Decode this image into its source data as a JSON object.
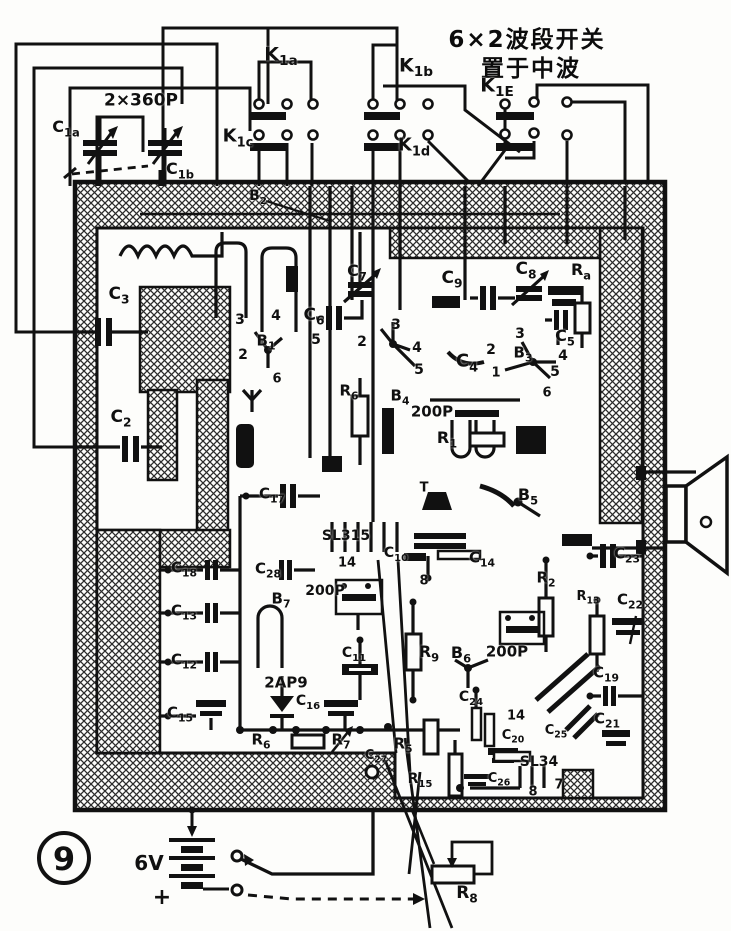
{
  "title": {
    "line1": "6×2波段开关",
    "line2": "置于中波"
  },
  "figure_number": "9",
  "colors": {
    "ink": "#111111",
    "paper": "#fdfdfb"
  },
  "battery": {
    "voltage": "6V",
    "polarity": "+"
  },
  "labels": [
    {
      "n": "switch-k1a-label",
      "t": "K1a",
      "sub": 1,
      "x": 281,
      "y": 57,
      "s": 19
    },
    {
      "n": "switch-k1b-label",
      "t": "K1b",
      "sub": 1,
      "x": 416,
      "y": 68,
      "s": 19
    },
    {
      "n": "switch-k1c-label",
      "t": "K1c",
      "sub": 1,
      "x": 238,
      "y": 139,
      "s": 18
    },
    {
      "n": "switch-k1d-label",
      "t": "K1d",
      "sub": 1,
      "x": 414,
      "y": 148,
      "s": 18
    },
    {
      "n": "switch-k1e-label",
      "t": "K1E",
      "sub": 1,
      "x": 497,
      "y": 88,
      "s": 19
    },
    {
      "n": "tuning-cap-value",
      "t": "2×360P",
      "x": 141,
      "y": 101,
      "s": 17
    },
    {
      "n": "cap-c1a-label",
      "t": "C1a",
      "sub": 1,
      "x": 66,
      "y": 129,
      "s": 16
    },
    {
      "n": "cap-c1b-label",
      "t": "C1b",
      "sub": 1,
      "x": 180,
      "y": 171,
      "s": 16
    },
    {
      "n": "shield-b2-label",
      "t": "B2",
      "sub": 1,
      "x": 258,
      "y": 198,
      "s": 14
    },
    {
      "n": "cap-c3-label",
      "t": "C3",
      "sub": 1,
      "x": 119,
      "y": 296,
      "s": 17
    },
    {
      "n": "cap-c2-label",
      "t": "C2",
      "sub": 1,
      "x": 121,
      "y": 419,
      "s": 17
    },
    {
      "n": "pin3-b1",
      "t": "3",
      "x": 240,
      "y": 320,
      "s": 14
    },
    {
      "n": "pin4-b1",
      "t": "4",
      "x": 276,
      "y": 316,
      "s": 14
    },
    {
      "n": "pin2-b1",
      "t": "2",
      "x": 243,
      "y": 355,
      "s": 14
    },
    {
      "n": "transistor-b1-label",
      "t": "B1",
      "sub": 1,
      "x": 266,
      "y": 343,
      "s": 15
    },
    {
      "n": "pin5-b1",
      "t": "5",
      "x": 316,
      "y": 340,
      "s": 14
    },
    {
      "n": "pin6-b1",
      "t": "6",
      "x": 277,
      "y": 379,
      "s": 13
    },
    {
      "n": "cap-c6-label",
      "t": "C6",
      "sub": 1,
      "x": 314,
      "y": 317,
      "s": 17
    },
    {
      "n": "cap-c7-label",
      "t": "C7",
      "sub": 1,
      "x": 357,
      "y": 273,
      "s": 16
    },
    {
      "n": "cap-c9-label",
      "t": "C9",
      "sub": 1,
      "x": 452,
      "y": 280,
      "s": 17
    },
    {
      "n": "cap-c8-label",
      "t": "C8",
      "sub": 1,
      "x": 526,
      "y": 271,
      "s": 17
    },
    {
      "n": "res-ra-label",
      "t": "Ra",
      "sub": 1,
      "x": 581,
      "y": 272,
      "s": 16
    },
    {
      "n": "pin3-b2",
      "t": "3",
      "x": 396,
      "y": 325,
      "s": 14
    },
    {
      "n": "pin2-b2",
      "t": "2",
      "x": 362,
      "y": 342,
      "s": 14
    },
    {
      "n": "pin4-b2",
      "t": "4",
      "x": 417,
      "y": 348,
      "s": 14
    },
    {
      "n": "pin5-b2",
      "t": "5",
      "x": 419,
      "y": 370,
      "s": 14
    },
    {
      "n": "cap-c4-label",
      "t": "C4",
      "sub": 1,
      "x": 467,
      "y": 364,
      "s": 18
    },
    {
      "n": "transistor-b3-label",
      "t": "B3",
      "sub": 1,
      "x": 523,
      "y": 355,
      "s": 15
    },
    {
      "n": "pin3-b3",
      "t": "3",
      "x": 520,
      "y": 334,
      "s": 14
    },
    {
      "n": "pin2-b3",
      "t": "2",
      "x": 491,
      "y": 350,
      "s": 14
    },
    {
      "n": "pin4-b3",
      "t": "4",
      "x": 563,
      "y": 356,
      "s": 14
    },
    {
      "n": "pin5-b3",
      "t": "5",
      "x": 555,
      "y": 372,
      "s": 14
    },
    {
      "n": "pin1-b3",
      "t": "1",
      "x": 496,
      "y": 373,
      "s": 13
    },
    {
      "n": "pin6-b3",
      "t": "6",
      "x": 547,
      "y": 393,
      "s": 13
    },
    {
      "n": "cap-c5-label",
      "t": "C5",
      "sub": 1,
      "x": 565,
      "y": 338,
      "s": 16
    },
    {
      "n": "res-r6-upper-label",
      "t": "R6",
      "sub": 1,
      "x": 349,
      "y": 393,
      "s": 15
    },
    {
      "n": "transistor-b4-label",
      "t": "B4",
      "sub": 1,
      "x": 400,
      "y": 398,
      "s": 15
    },
    {
      "n": "trimmer-200p-1",
      "t": "200P",
      "x": 432,
      "y": 412,
      "s": 15
    },
    {
      "n": "res-r1-label",
      "t": "R1",
      "sub": 1,
      "x": 447,
      "y": 440,
      "s": 16
    },
    {
      "n": "t-mark",
      "t": "T",
      "x": 424,
      "y": 488,
      "s": 13
    },
    {
      "n": "transistor-b5-label",
      "t": "B5",
      "sub": 1,
      "x": 528,
      "y": 497,
      "s": 16
    },
    {
      "n": "cap-c17-label",
      "t": "C17",
      "sub": 1,
      "x": 272,
      "y": 496,
      "s": 15
    },
    {
      "n": "cap-c28-label",
      "t": "C28",
      "sub": 1,
      "x": 268,
      "y": 571,
      "s": 15
    },
    {
      "n": "ic-sl315-label",
      "t": "SL315",
      "x": 346,
      "y": 536,
      "s": 14
    },
    {
      "n": "pin14-sl315",
      "t": "14",
      "x": 347,
      "y": 563,
      "s": 13
    },
    {
      "n": "cap-c10-label",
      "t": "C10",
      "sub": 1,
      "x": 396,
      "y": 555,
      "s": 14
    },
    {
      "n": "pin8-sl315",
      "t": "8",
      "x": 424,
      "y": 581,
      "s": 13
    },
    {
      "n": "cap-c14-label",
      "t": "C14",
      "sub": 1,
      "x": 482,
      "y": 560,
      "s": 15
    },
    {
      "n": "cap-c18-label",
      "t": "C18",
      "sub": 1,
      "x": 184,
      "y": 570,
      "s": 15
    },
    {
      "n": "cap-c13-label",
      "t": "C13",
      "sub": 1,
      "x": 184,
      "y": 613,
      "s": 15
    },
    {
      "n": "transistor-b7-label",
      "t": "B7",
      "sub": 1,
      "x": 281,
      "y": 601,
      "s": 15
    },
    {
      "n": "trimmer-200p-2",
      "t": "200P",
      "x": 325,
      "y": 591,
      "s": 14
    },
    {
      "n": "cap-c12-label",
      "t": "C12",
      "sub": 1,
      "x": 184,
      "y": 662,
      "s": 15
    },
    {
      "n": "diode-2ap9-label",
      "t": "2AP9",
      "x": 286,
      "y": 683,
      "s": 15
    },
    {
      "n": "cap-c11-label",
      "t": "C11",
      "sub": 1,
      "x": 354,
      "y": 655,
      "s": 14
    },
    {
      "n": "cap-c15-label",
      "t": "C15",
      "sub": 1,
      "x": 180,
      "y": 715,
      "s": 15
    },
    {
      "n": "cap-c16-label",
      "t": "C16",
      "sub": 1,
      "x": 308,
      "y": 703,
      "s": 14
    },
    {
      "n": "res-r6-lower-label",
      "t": "R6",
      "sub": 1,
      "x": 261,
      "y": 742,
      "s": 15
    },
    {
      "n": "res-r7-label",
      "t": "R7",
      "sub": 1,
      "x": 341,
      "y": 742,
      "s": 15
    },
    {
      "n": "cap-c27-label",
      "t": "C27",
      "sub": 1,
      "x": 376,
      "y": 757,
      "s": 13
    },
    {
      "n": "res-r5-label",
      "t": "R5",
      "sub": 1,
      "x": 403,
      "y": 746,
      "s": 15
    },
    {
      "n": "res-r15-label",
      "t": "R15",
      "sub": 1,
      "x": 420,
      "y": 781,
      "s": 14
    },
    {
      "n": "res-r9-label",
      "t": "R9",
      "sub": 1,
      "x": 429,
      "y": 654,
      "s": 16
    },
    {
      "n": "transistor-b6-label",
      "t": "B6",
      "sub": 1,
      "x": 461,
      "y": 655,
      "s": 16
    },
    {
      "n": "trimmer-200p-3",
      "t": "200P",
      "x": 507,
      "y": 652,
      "s": 15
    },
    {
      "n": "res-r2-label",
      "t": "R2",
      "sub": 1,
      "x": 546,
      "y": 580,
      "s": 15
    },
    {
      "n": "cap-c24-label",
      "t": "C24",
      "sub": 1,
      "x": 471,
      "y": 699,
      "s": 14
    },
    {
      "n": "pin14-sl34",
      "t": "14",
      "x": 516,
      "y": 716,
      "s": 13
    },
    {
      "n": "cap-c20-label",
      "t": "C20",
      "sub": 1,
      "x": 513,
      "y": 737,
      "s": 13
    },
    {
      "n": "cap-c25-label",
      "t": "C25",
      "sub": 1,
      "x": 556,
      "y": 732,
      "s": 13
    },
    {
      "n": "ic-sl34-label",
      "t": "SL34",
      "x": 539,
      "y": 762,
      "s": 14
    },
    {
      "n": "cap-c26-label",
      "t": "C26",
      "sub": 1,
      "x": 499,
      "y": 780,
      "s": 13
    },
    {
      "n": "pin8-sl34",
      "t": "8",
      "x": 533,
      "y": 792,
      "s": 13
    },
    {
      "n": "pin7-sl34",
      "t": "7",
      "x": 559,
      "y": 785,
      "s": 13
    },
    {
      "n": "cap-c23-label",
      "t": "C23",
      "sub": 1,
      "x": 627,
      "y": 556,
      "s": 15
    },
    {
      "n": "res-r13-label",
      "t": "R13",
      "sub": 1,
      "x": 588,
      "y": 598,
      "s": 13
    },
    {
      "n": "cap-c22-label",
      "t": "C22",
      "sub": 1,
      "x": 630,
      "y": 602,
      "s": 15
    },
    {
      "n": "cap-c19-label",
      "t": "C19",
      "sub": 1,
      "x": 606,
      "y": 675,
      "s": 15
    },
    {
      "n": "cap-c21-label",
      "t": "C21",
      "sub": 1,
      "x": 607,
      "y": 721,
      "s": 15
    },
    {
      "n": "figure-number",
      "t": "9",
      "x": 64,
      "y": 859,
      "s": 32
    },
    {
      "n": "battery-voltage-label",
      "t": "6V",
      "x": 149,
      "y": 863,
      "s": 20
    },
    {
      "n": "battery-plus-label",
      "t": "+",
      "x": 162,
      "y": 898,
      "s": 22
    },
    {
      "n": "pot-r8-label",
      "t": "R8",
      "sub": 1,
      "x": 467,
      "y": 895,
      "s": 17
    }
  ]
}
